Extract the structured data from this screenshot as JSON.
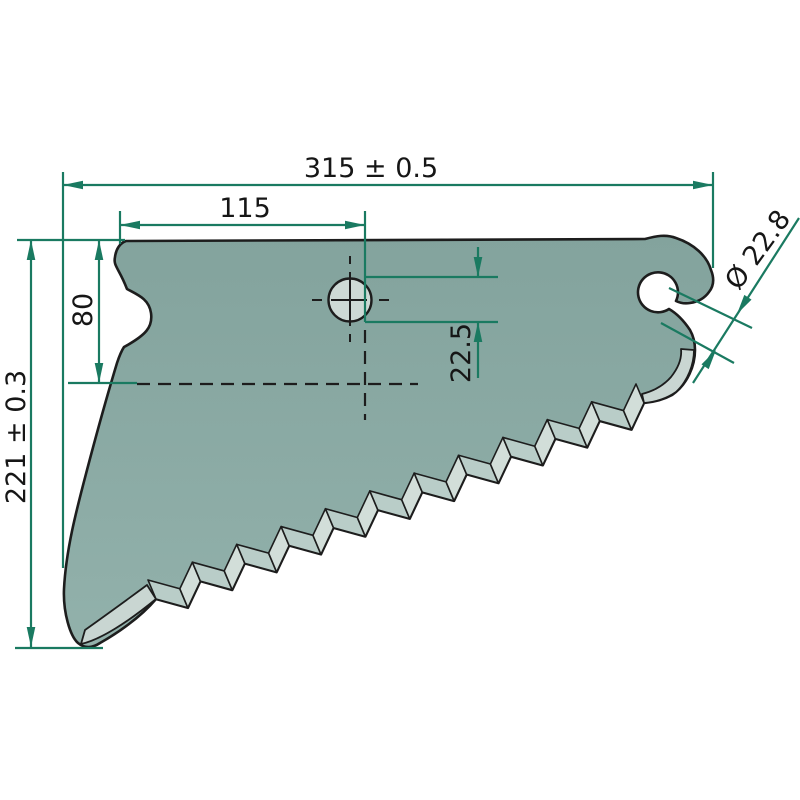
{
  "drawing": {
    "canvas": {
      "width": 800,
      "height": 800,
      "background": "#ffffff"
    },
    "colors": {
      "body_top": "#83a39d",
      "body_bottom": "#92b1ab",
      "facet_left": "#b9cdc8",
      "facet_right": "#d2ded9",
      "bevel_band": "#c9d6d2",
      "hole_fill": "#cdd9d5",
      "outline": "#1d1d1d",
      "dimension": "#1a7a61",
      "text": "#161616"
    },
    "blade": {
      "outline_front": "M 126 241 L 645 239 C 656 236 666 234 676 238 C 694 244 707 256 711 270 C 715 280 713 287 709 292 C 704 299 697 302 690 303 C 684 304 680 303 676 301 A 20 20 0 1 0 669 309 C 676 313 684 321 690 330 C 694 337 695 344 695 350 C 695 365 688 384 672 395 C 663 400 654 402 644 403",
      "outline_back": "C 140 618 116 634 100 643 C 91 649 84 648 78 643 C 70 636 63 612 64 589 C 66 549 77 508 87 470 C 97 432 107 396 117 363 C 120 354 122 350 124 347 C 146 335 153 327 151 313 C 149 299 138 295 127 289 C 119 268 113 266 115 257 C 116 249 120 243 126 241 Z",
      "teeth": {
        "count": 11,
        "start": [
          156,
          599
        ],
        "end": [
          644,
          403
        ],
        "tip_pos": 0.55,
        "tip_out": 20,
        "bevel_dx": -8,
        "bevel_dy": -19
      },
      "heel_bevel": "M 81 644 C 100 640 128 622 156 599 L 147 585 C 124 602 99 620 85 630 Z",
      "tip_bevel": "M 694 350 C 694 364 688 381 676 392 C 666 399 656 402 644 403 L 642 394 C 654 391 664 385 671 377 C 679 367 682 358 681 349 Z",
      "hole": {
        "cx": 350,
        "cy": 300,
        "r": 21.5
      }
    },
    "center_marks": [
      [
        350,
        256,
        350,
        264
      ],
      [
        350,
        272,
        350,
        326
      ],
      [
        350,
        334,
        350,
        342
      ],
      [
        312,
        300,
        322,
        300
      ],
      [
        331,
        300,
        367,
        300
      ],
      [
        379,
        300,
        389,
        300
      ]
    ],
    "dashed_centerlines": [
      [
        365,
        330,
        365,
        420
      ],
      [
        137,
        384,
        418,
        384
      ]
    ],
    "extension_lines": [
      [
        63,
        172,
        63,
        568
      ],
      [
        713,
        172,
        713,
        268
      ],
      [
        120,
        211,
        120,
        244
      ],
      [
        365,
        211,
        365,
        322
      ],
      [
        17,
        240,
        125,
        240
      ],
      [
        68,
        383,
        137,
        383
      ],
      [
        15,
        648,
        103,
        648
      ],
      [
        365,
        277,
        498,
        277
      ],
      [
        365,
        322,
        498,
        322
      ],
      [
        669,
        288,
        752,
        328
      ],
      [
        661,
        323,
        734,
        363
      ]
    ],
    "dimension_lines": [
      {
        "seg": [
          63,
          185,
          713,
          185
        ],
        "arrows": [
          [
            63,
            185,
            -1,
            0
          ],
          [
            713,
            185,
            1,
            0
          ]
        ]
      },
      {
        "seg": [
          120,
          225,
          365,
          225
        ],
        "arrows": [
          [
            120,
            225,
            -1,
            0
          ],
          [
            365,
            225,
            1,
            0
          ]
        ]
      },
      {
        "seg": [
          99,
          240,
          99,
          383
        ],
        "arrows": [
          [
            99,
            240,
            0,
            -1
          ],
          [
            99,
            383,
            0,
            1
          ]
        ]
      },
      {
        "seg": [
          31,
          240,
          31,
          647
        ],
        "arrows": [
          [
            31,
            240,
            0,
            -1
          ],
          [
            31,
            647,
            0,
            1
          ]
        ]
      },
      {
        "seg": [
          478,
          247,
          478,
          277
        ],
        "arrows": [
          [
            478,
            277,
            0,
            1
          ]
        ]
      },
      {
        "seg": [
          478,
          322,
          478,
          378
        ],
        "arrows": [
          [
            478,
            322,
            0,
            -1
          ]
        ]
      },
      {
        "seg": [
          799,
          218,
          693,
          383
        ],
        "arrows": [
          [
            737,
            314,
            -0.546,
            0.838
          ],
          [
            716,
            350,
            0.546,
            -0.838
          ]
        ]
      }
    ],
    "labels": [
      {
        "name": "total-width",
        "text": "315 ± 0.5",
        "tx": 371,
        "ty": 177,
        "rotate": 0
      },
      {
        "name": "hole-center-x",
        "text": "115",
        "tx": 245,
        "ty": 217,
        "rotate": 0
      },
      {
        "name": "hole-center-y",
        "text": "80",
        "tx": 92,
        "ty": 310,
        "rotate": -90
      },
      {
        "name": "total-height",
        "text": "221 ± 0.3",
        "tx": 25,
        "ty": 437,
        "rotate": -90
      },
      {
        "name": "hole-edge-offset",
        "text": "22.5",
        "tx": 470,
        "ty": 353,
        "rotate": -90
      },
      {
        "name": "hook-opening-dia",
        "text": "Ø 22.8",
        "tx": 765,
        "ty": 255,
        "rotate": -54
      }
    ]
  }
}
